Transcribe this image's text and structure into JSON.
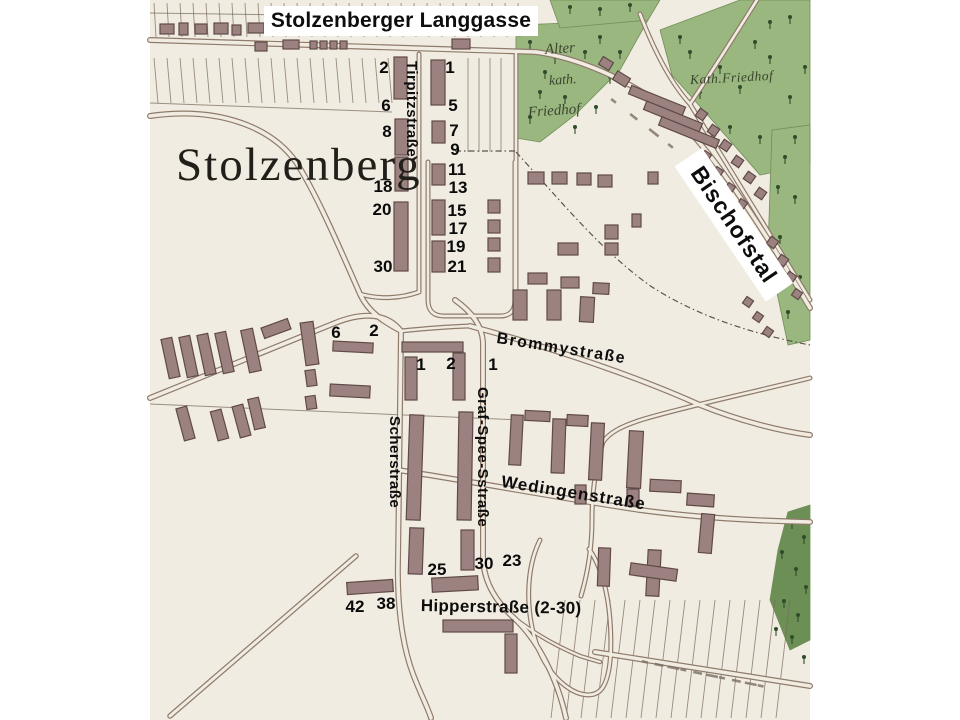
{
  "map": {
    "title": "Stolzenberger Langgasse",
    "place_label": "Stolzenberg",
    "labels": {
      "tirpitzstrasse": "Tirpitzstraße",
      "bischofstal": "Bischofstal",
      "brommystrasse": "Brommystraße",
      "scherstrasse": "Scherstraße",
      "graf_spee_strasse": "Graf-Spee-Sstraße",
      "wedingenstrasse": "Wedingenstraße",
      "hipperstrasse": "Hipperstraße (2-30)",
      "alter_kath_friedhof_line1": "Alter",
      "alter_kath_friedhof_line2": "kath.",
      "alter_kath_friedhof_line3": "Friedhof",
      "kath_friedhof": "Kath.Friedhof"
    },
    "house_numbers": [
      {
        "t": "2",
        "x": 384,
        "y": 68
      },
      {
        "t": "6",
        "x": 386,
        "y": 106
      },
      {
        "t": "8",
        "x": 387,
        "y": 132
      },
      {
        "t": "18",
        "x": 383,
        "y": 187
      },
      {
        "t": "20",
        "x": 382,
        "y": 210
      },
      {
        "t": "30",
        "x": 383,
        "y": 267
      },
      {
        "t": "1",
        "x": 450,
        "y": 68
      },
      {
        "t": "5",
        "x": 453,
        "y": 106
      },
      {
        "t": "7",
        "x": 454,
        "y": 131
      },
      {
        "t": "9",
        "x": 455,
        "y": 150
      },
      {
        "t": "11",
        "x": 457,
        "y": 170
      },
      {
        "t": "13",
        "x": 458,
        "y": 188
      },
      {
        "t": "15",
        "x": 457,
        "y": 211
      },
      {
        "t": "17",
        "x": 458,
        "y": 229
      },
      {
        "t": "19",
        "x": 456,
        "y": 247
      },
      {
        "t": "21",
        "x": 457,
        "y": 267
      },
      {
        "t": "6",
        "x": 336,
        "y": 333
      },
      {
        "t": "2",
        "x": 374,
        "y": 331
      },
      {
        "t": "1",
        "x": 421,
        "y": 365
      },
      {
        "t": "2",
        "x": 451,
        "y": 364
      },
      {
        "t": "1",
        "x": 493,
        "y": 365
      },
      {
        "t": "25",
        "x": 437,
        "y": 570
      },
      {
        "t": "30",
        "x": 484,
        "y": 564
      },
      {
        "t": "23",
        "x": 512,
        "y": 561
      },
      {
        "t": "42",
        "x": 355,
        "y": 607
      },
      {
        "t": "38",
        "x": 386,
        "y": 604
      }
    ],
    "colors": {
      "paper": "#f1ece1",
      "building_fill": "#9c8181",
      "building_stroke": "#5f4a47",
      "road_casing": "#8f7b6c",
      "green": "#9ab77f",
      "green_dark": "#6c8f55",
      "tree": "#2f4d2a",
      "line": "#7a6a5b",
      "label": "#0d0d0d"
    }
  },
  "map_features": {
    "map_bounds": {
      "x": 150,
      "y": 0,
      "w": 660,
      "h": 720
    },
    "green_areas": [
      {
        "pts": "516,25 648,20 620,70 575,115 540,142 516,138",
        "dark": false
      },
      {
        "pts": "660,30 740,0 810,0 810,165 760,175 712,120 672,75",
        "dark": false
      },
      {
        "pts": "772,130 810,125 810,340 788,345 768,250",
        "dark": false
      },
      {
        "pts": "788,512 810,505 810,640 790,650 770,600 778,550",
        "dark": true
      },
      {
        "pts": "550,0 660,0 648,20 560,28",
        "dark": false
      }
    ],
    "trees": [
      [
        530,
        45
      ],
      [
        555,
        60
      ],
      [
        540,
        95
      ],
      [
        565,
        100
      ],
      [
        530,
        120
      ],
      [
        585,
        55
      ],
      [
        600,
        40
      ],
      [
        610,
        80
      ],
      [
        545,
        75
      ],
      [
        575,
        130
      ],
      [
        596,
        110
      ],
      [
        620,
        55
      ],
      [
        690,
        55
      ],
      [
        720,
        70
      ],
      [
        700,
        95
      ],
      [
        740,
        90
      ],
      [
        770,
        60
      ],
      [
        790,
        100
      ],
      [
        730,
        130
      ],
      [
        760,
        140
      ],
      [
        795,
        140
      ],
      [
        680,
        40
      ],
      [
        755,
        45
      ],
      [
        805,
        70
      ],
      [
        790,
        20
      ],
      [
        770,
        25
      ],
      [
        785,
        160
      ],
      [
        795,
        200
      ],
      [
        780,
        240
      ],
      [
        800,
        280
      ],
      [
        788,
        315
      ],
      [
        778,
        190
      ],
      [
        792,
        525
      ],
      [
        804,
        540
      ],
      [
        782,
        555
      ],
      [
        796,
        572
      ],
      [
        806,
        590
      ],
      [
        784,
        604
      ],
      [
        798,
        618
      ],
      [
        776,
        632
      ],
      [
        792,
        640
      ],
      [
        804,
        660
      ],
      [
        570,
        10
      ],
      [
        600,
        12
      ],
      [
        630,
        8
      ]
    ],
    "roads": [
      {
        "d": "M150,40 L536,52",
        "w": 6
      },
      {
        "d": "M536,52 C580,58 625,80 658,102 C700,132 755,215 810,308",
        "w": 6
      },
      {
        "d": "M640,14 C652,45 668,80 690,104",
        "w": 5
      },
      {
        "d": "M690,104 L810,300",
        "w": 5
      },
      {
        "d": "M757,0 C735,35 710,75 690,104",
        "w": 5
      },
      {
        "d": "M516,54 L516,298",
        "w": 5
      },
      {
        "d": "M428,162 L428,300 Q428,316 444,316 L500,316 Q515,316 515,300 L515,162",
        "w": 5
      },
      {
        "d": "M419,54 L419,292",
        "w": 5
      },
      {
        "d": "M150,116 C220,106 272,128 296,162 C318,196 344,258 360,294 C368,312 384,322 401,331",
        "w": 6
      },
      {
        "d": "M360,294 C380,300 402,298 419,292",
        "w": 5
      },
      {
        "d": "M150,398 L335,323 C365,311 388,314 401,331",
        "w": 6
      },
      {
        "d": "M401,331 L398,560 C397,600 401,642 413,674 C421,695 428,708 431,718",
        "w": 6
      },
      {
        "d": "M455,300 C472,312 482,326 483,342 L483,556 C483,580 494,600 514,618 C540,642 558,682 566,718",
        "w": 6
      },
      {
        "d": "M401,331 Q440,327 470,326",
        "w": 5
      },
      {
        "d": "M470,326 C560,350 640,378 700,405 C740,421 780,431 810,435",
        "w": 6
      },
      {
        "d": "M810,378 C745,394 688,406 644,419 C621,426 609,433 603,442 C595,468 592,494 592,520 C592,546 588,572 581,596",
        "w": 5
      },
      {
        "d": "M398,470 C480,483 560,498 640,510 C700,518 762,521 810,522",
        "w": 6
      },
      {
        "d": "M540,540 C529,562 526,592 531,622 C536,652 549,674 567,687 C581,697 596,698 603,687 C611,674 612,648 610,620 C608,592 601,566 589,549",
        "w": 5
      },
      {
        "d": "M356,556 L170,716",
        "w": 5.5
      },
      {
        "d": "M595,652 L810,686",
        "w": 6
      },
      {
        "d": "M513,617 C532,632 556,646 580,656 L600,662",
        "w": 4.5
      }
    ],
    "dashed_lines": [
      "M455,151 L515,151",
      "M516,152 C560,200 602,252 652,287 C696,315 748,333 810,345"
    ],
    "thin_lines": [
      "M150,404 L520,420",
      "M150,13 L432,17",
      "M150,103 L392,112"
    ],
    "strip_groups": [
      {
        "x0": 154,
        "x1": 530,
        "step": 13,
        "y0": 3,
        "y1": 37,
        "lean": 2
      },
      {
        "x0": 154,
        "x1": 390,
        "step": 13,
        "y0": 58,
        "y1": 103,
        "lean": 4
      },
      {
        "x0": 468,
        "x1": 510,
        "step": 11,
        "y0": 58,
        "y1": 152,
        "lean": 0
      },
      {
        "x0": 565,
        "x1": 800,
        "step": 15,
        "y0": 600,
        "y1": 718,
        "lean": -14
      }
    ],
    "buildings": [
      [
        394,
        57,
        13,
        42,
        0
      ],
      [
        395,
        119,
        13,
        36,
        0
      ],
      [
        395,
        157,
        13,
        34,
        0
      ],
      [
        394,
        202,
        14,
        69,
        0
      ],
      [
        431,
        60,
        14,
        45,
        0
      ],
      [
        432,
        121,
        13,
        22,
        0
      ],
      [
        432,
        164,
        13,
        21,
        0
      ],
      [
        432,
        200,
        13,
        35,
        0
      ],
      [
        432,
        241,
        13,
        31,
        0
      ],
      [
        488,
        200,
        12,
        13,
        0
      ],
      [
        488,
        220,
        12,
        13,
        0
      ],
      [
        488,
        238,
        12,
        13,
        0
      ],
      [
        488,
        258,
        12,
        14,
        0
      ],
      [
        160,
        24,
        14,
        10,
        0
      ],
      [
        179,
        23,
        9,
        12,
        0
      ],
      [
        195,
        24,
        12,
        10,
        0
      ],
      [
        214,
        23,
        14,
        11,
        0
      ],
      [
        232,
        25,
        9,
        10,
        0
      ],
      [
        248,
        23,
        16,
        10,
        0
      ],
      [
        269,
        24,
        10,
        10,
        0
      ],
      [
        283,
        23,
        12,
        10,
        0
      ],
      [
        300,
        24,
        10,
        9,
        0
      ],
      [
        358,
        21,
        12,
        10,
        0
      ],
      [
        375,
        23,
        10,
        10,
        0
      ],
      [
        404,
        20,
        13,
        11,
        0
      ],
      [
        452,
        39,
        18,
        10,
        0
      ],
      [
        470,
        21,
        12,
        10,
        0
      ],
      [
        310,
        41,
        7,
        8,
        0
      ],
      [
        320,
        41,
        7,
        8,
        0
      ],
      [
        330,
        41,
        7,
        8,
        0
      ],
      [
        340,
        41,
        7,
        8,
        0
      ],
      [
        283,
        40,
        16,
        9,
        0
      ],
      [
        255,
        42,
        12,
        9,
        0
      ],
      [
        614,
        74,
        15,
        10,
        32
      ],
      [
        600,
        59,
        12,
        9,
        32
      ],
      [
        628,
        96,
        58,
        9,
        22
      ],
      [
        643,
        112,
        60,
        9,
        22
      ],
      [
        658,
        128,
        62,
        9,
        22
      ],
      [
        697,
        110,
        9,
        9,
        35
      ],
      [
        709,
        126,
        9,
        9,
        35
      ],
      [
        721,
        141,
        9,
        9,
        35
      ],
      [
        733,
        157,
        9,
        9,
        35
      ],
      [
        745,
        173,
        9,
        9,
        35
      ],
      [
        756,
        189,
        9,
        9,
        35
      ],
      [
        702,
        152,
        8,
        8,
        35
      ],
      [
        714,
        168,
        8,
        8,
        35
      ],
      [
        726,
        184,
        8,
        8,
        35
      ],
      [
        738,
        200,
        8,
        8,
        35
      ],
      [
        768,
        238,
        9,
        9,
        35
      ],
      [
        778,
        256,
        9,
        9,
        35
      ],
      [
        786,
        273,
        9,
        9,
        35
      ],
      [
        793,
        290,
        8,
        8,
        35
      ],
      [
        744,
        298,
        8,
        8,
        35
      ],
      [
        754,
        313,
        8,
        8,
        35
      ],
      [
        764,
        328,
        8,
        8,
        35
      ],
      [
        528,
        172,
        16,
        12,
        0
      ],
      [
        552,
        172,
        15,
        12,
        0
      ],
      [
        577,
        173,
        14,
        12,
        0
      ],
      [
        598,
        175,
        14,
        12,
        0
      ],
      [
        648,
        172,
        10,
        12,
        0
      ],
      [
        558,
        243,
        20,
        12,
        0
      ],
      [
        605,
        225,
        13,
        14,
        0
      ],
      [
        605,
        243,
        13,
        12,
        0
      ],
      [
        632,
        214,
        9,
        13,
        0
      ],
      [
        528,
        273,
        19,
        11,
        0
      ],
      [
        561,
        277,
        18,
        11,
        0
      ],
      [
        593,
        283,
        16,
        11,
        3
      ],
      [
        513,
        290,
        14,
        30,
        0
      ],
      [
        547,
        290,
        14,
        30,
        0
      ],
      [
        580,
        297,
        14,
        25,
        3
      ],
      [
        165,
        338,
        11,
        40,
        -12
      ],
      [
        183,
        336,
        11,
        41,
        -12
      ],
      [
        201,
        334,
        11,
        41,
        -12
      ],
      [
        219,
        332,
        11,
        41,
        -12
      ],
      [
        245,
        329,
        12,
        43,
        -12
      ],
      [
        262,
        323,
        28,
        11,
        -20
      ],
      [
        303,
        322,
        13,
        43,
        -8
      ],
      [
        306,
        370,
        10,
        16,
        -8
      ],
      [
        306,
        396,
        10,
        13,
        -8
      ],
      [
        180,
        407,
        11,
        33,
        -15
      ],
      [
        214,
        410,
        11,
        30,
        -15
      ],
      [
        236,
        405,
        11,
        32,
        -15
      ],
      [
        251,
        398,
        11,
        31,
        -13
      ],
      [
        333,
        342,
        40,
        10,
        3
      ],
      [
        330,
        385,
        40,
        12,
        3
      ],
      [
        402,
        342,
        61,
        10,
        0
      ],
      [
        405,
        357,
        12,
        43,
        0
      ],
      [
        453,
        353,
        12,
        47,
        0
      ],
      [
        408,
        415,
        14,
        105,
        2
      ],
      [
        458,
        412,
        14,
        108,
        1
      ],
      [
        409,
        528,
        14,
        46,
        2
      ],
      [
        461,
        530,
        13,
        40,
        0
      ],
      [
        432,
        577,
        46,
        14,
        -3
      ],
      [
        347,
        581,
        46,
        12,
        -4
      ],
      [
        443,
        620,
        70,
        12,
        0
      ],
      [
        505,
        634,
        12,
        39,
        0
      ],
      [
        510,
        415,
        12,
        50,
        3
      ],
      [
        552,
        419,
        13,
        54,
        2
      ],
      [
        590,
        423,
        13,
        57,
        3
      ],
      [
        628,
        431,
        14,
        57,
        3
      ],
      [
        525,
        411,
        25,
        10,
        3
      ],
      [
        567,
        415,
        21,
        11,
        3
      ],
      [
        575,
        485,
        11,
        19,
        0
      ],
      [
        627,
        489,
        12,
        17,
        0
      ],
      [
        650,
        480,
        31,
        12,
        3
      ],
      [
        687,
        494,
        27,
        12,
        4
      ],
      [
        700,
        514,
        13,
        39,
        5
      ],
      [
        647,
        550,
        13,
        46,
        3
      ],
      [
        598,
        548,
        12,
        38,
        2
      ],
      [
        630,
        566,
        47,
        12,
        8
      ]
    ],
    "faded_text_dashes": [
      {
        "x": 642,
        "y": 660,
        "x2": 758,
        "y2": 684,
        "n": 10
      },
      {
        "x": 612,
        "y": 98,
        "x2": 688,
        "y2": 158,
        "n": 5
      }
    ]
  }
}
